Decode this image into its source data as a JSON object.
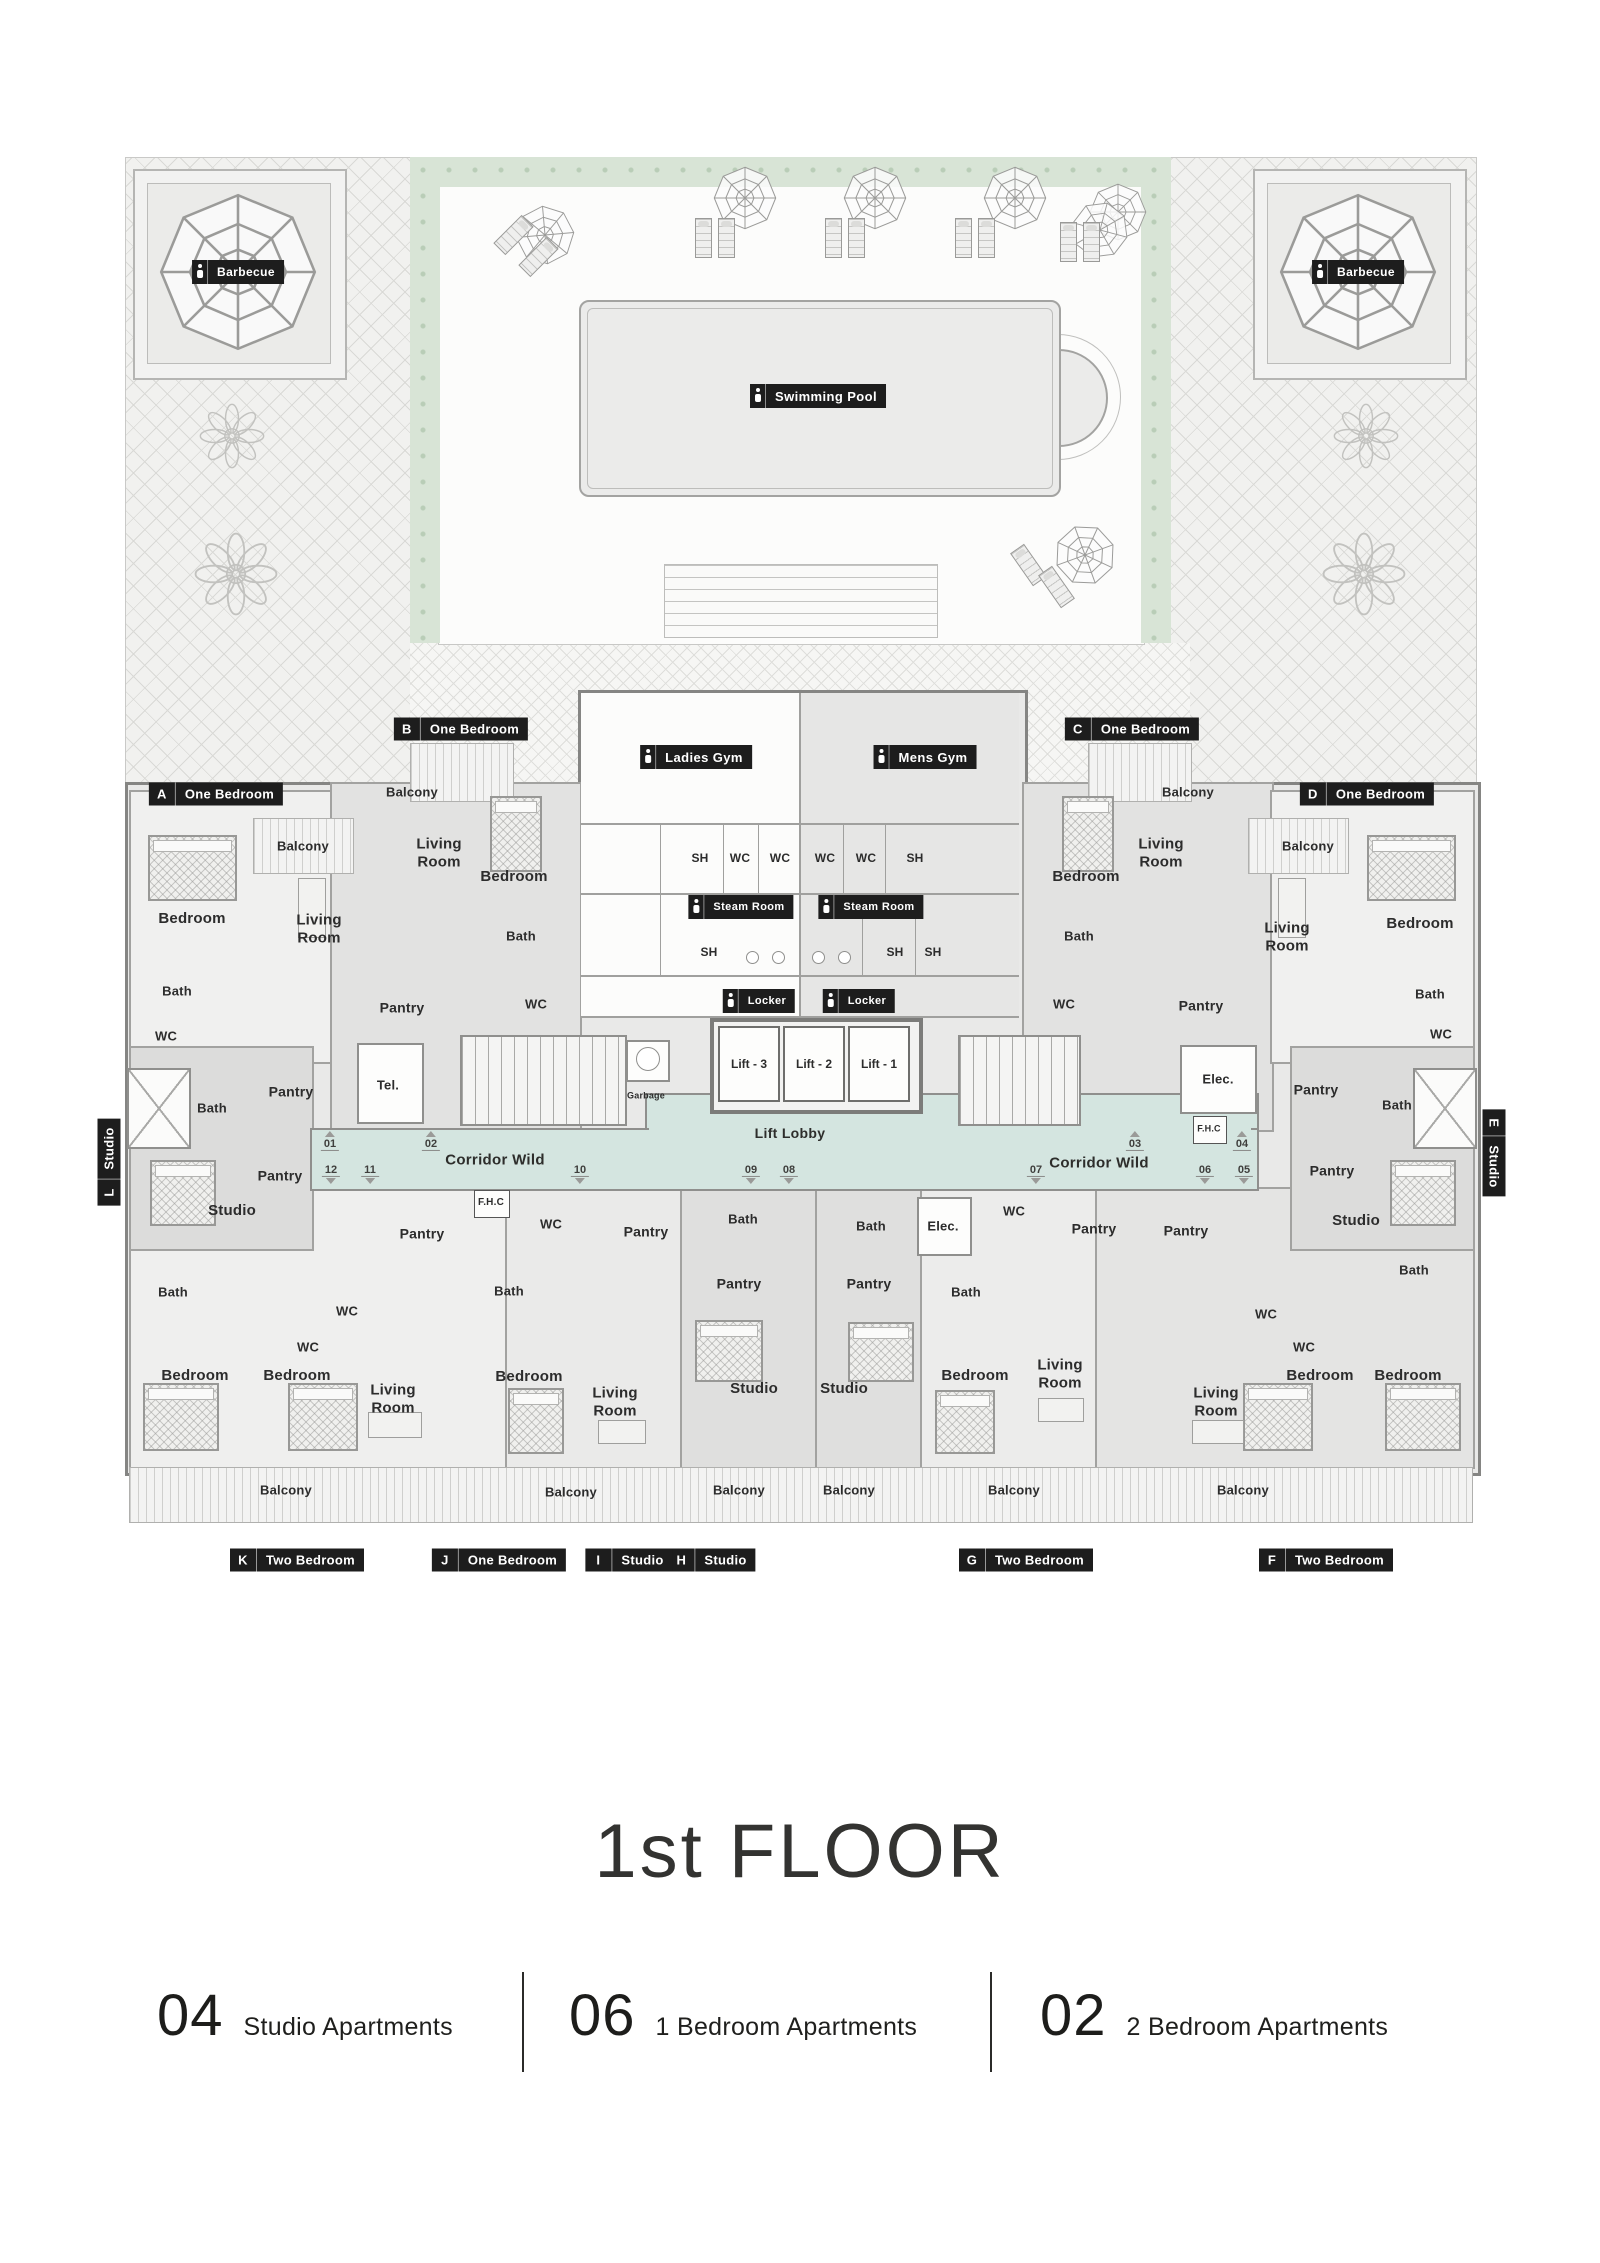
{
  "title": {
    "text": "1st FLOOR"
  },
  "legend": {
    "items": [
      {
        "count": "04",
        "label": "Studio Apartments"
      },
      {
        "count": "06",
        "label": "1 Bedroom Apartments"
      },
      {
        "count": "02",
        "label": "2 Bedroom Apartments"
      }
    ]
  },
  "colors": {
    "corridor": "#d4e5e0",
    "label_bg": "#1d1d1d",
    "hedge": "#d8e4d6"
  },
  "corridor": {
    "left": "Corridor Wild",
    "right": "Corridor Wild",
    "lobby": "Lift Lobby"
  },
  "lifts": [
    "Lift - 3",
    "Lift - 2",
    "Lift - 1"
  ],
  "amenity_labels": [
    {
      "id": "barbecue-left",
      "icon": "barbecue-icon",
      "text": "Barbecue",
      "x": 238,
      "y": 272,
      "fs": 12
    },
    {
      "id": "barbecue-right",
      "icon": "barbecue-icon",
      "text": "Barbecue",
      "x": 1358,
      "y": 272,
      "fs": 12
    },
    {
      "id": "swimming-pool",
      "icon": "swimmer-icon",
      "text": "Swimming Pool",
      "x": 818,
      "y": 396,
      "fs": 13
    },
    {
      "id": "ladies-gym",
      "icon": "person-icon",
      "text": "Ladies Gym",
      "x": 696,
      "y": 757,
      "fs": 13
    },
    {
      "id": "mens-gym",
      "icon": "person-icon",
      "text": "Mens Gym",
      "x": 925,
      "y": 757,
      "fs": 13
    },
    {
      "id": "steam-room-left",
      "icon": "person-icon",
      "text": "Steam Room",
      "x": 741,
      "y": 907,
      "fs": 11
    },
    {
      "id": "steam-room-right",
      "icon": "person-icon",
      "text": "Steam Room",
      "x": 871,
      "y": 907,
      "fs": 11
    },
    {
      "id": "locker-left",
      "icon": "person-icon",
      "text": "Locker",
      "x": 759,
      "y": 1001,
      "fs": 11
    },
    {
      "id": "locker-right",
      "icon": "person-icon",
      "text": "Locker",
      "x": 859,
      "y": 1001,
      "fs": 11
    }
  ],
  "units": [
    {
      "letter": "A",
      "type": "One Bedroom",
      "x": 216,
      "y": 794,
      "dir": "h"
    },
    {
      "letter": "B",
      "type": "One Bedroom",
      "x": 461,
      "y": 729,
      "dir": "h"
    },
    {
      "letter": "C",
      "type": "One Bedroom",
      "x": 1132,
      "y": 729,
      "dir": "h"
    },
    {
      "letter": "D",
      "type": "One Bedroom",
      "x": 1367,
      "y": 794,
      "dir": "h"
    },
    {
      "letter": "E",
      "type": "Studio",
      "x": 1494,
      "y": 1153,
      "dir": "vd"
    },
    {
      "letter": "F",
      "type": "Two Bedroom",
      "x": 1326,
      "y": 1560,
      "dir": "h"
    },
    {
      "letter": "G",
      "type": "Two Bedroom",
      "x": 1026,
      "y": 1560,
      "dir": "h"
    },
    {
      "letter": "H",
      "type": "Studio",
      "x": 712,
      "y": 1560,
      "dir": "h"
    },
    {
      "letter": "I",
      "type": "Studio",
      "x": 629,
      "y": 1560,
      "dir": "h"
    },
    {
      "letter": "J",
      "type": "One Bedroom",
      "x": 499,
      "y": 1560,
      "dir": "h"
    },
    {
      "letter": "K",
      "type": "Two Bedroom",
      "x": 297,
      "y": 1560,
      "dir": "h"
    },
    {
      "letter": "L",
      "type": "Studio",
      "x": 109,
      "y": 1162,
      "dir": "vu"
    }
  ],
  "doors": {
    "top": [
      {
        "n": "01",
        "x": 330
      },
      {
        "n": "02",
        "x": 431
      },
      {
        "n": "03",
        "x": 1135
      },
      {
        "n": "04",
        "x": 1242
      }
    ],
    "bottom": [
      {
        "n": "12",
        "x": 331
      },
      {
        "n": "11",
        "x": 370
      },
      {
        "n": "10",
        "x": 580
      },
      {
        "n": "09",
        "x": 751
      },
      {
        "n": "08",
        "x": 789
      },
      {
        "n": "07",
        "x": 1036
      },
      {
        "n": "06",
        "x": 1205
      },
      {
        "n": "05",
        "x": 1244
      }
    ]
  },
  "room_labels": [
    {
      "t": "Balcony",
      "x": 303,
      "y": 846,
      "fs": 13
    },
    {
      "t": "Bedroom",
      "x": 192,
      "y": 919
    },
    {
      "t": "Living Room",
      "x": 319,
      "y": 929,
      "w": 58
    },
    {
      "t": "Bath",
      "x": 177,
      "y": 991,
      "fs": 13
    },
    {
      "t": "WC",
      "x": 166,
      "y": 1036,
      "fs": 13
    },
    {
      "t": "Balcony",
      "x": 412,
      "y": 792,
      "fs": 13
    },
    {
      "t": "Living Room",
      "x": 439,
      "y": 853,
      "w": 58
    },
    {
      "t": "Bedroom",
      "x": 514,
      "y": 877
    },
    {
      "t": "Bath",
      "x": 521,
      "y": 936,
      "fs": 13
    },
    {
      "t": "WC",
      "x": 536,
      "y": 1004,
      "fs": 13
    },
    {
      "t": "Pantry",
      "x": 402,
      "y": 1008,
      "fs": 14
    },
    {
      "t": "Tel.",
      "x": 388,
      "y": 1085,
      "fs": 13
    },
    {
      "t": "Garbage",
      "x": 646,
      "y": 1096,
      "fs": 9
    },
    {
      "t": "Balcony",
      "x": 1188,
      "y": 792,
      "fs": 13
    },
    {
      "t": "Living Room",
      "x": 1161,
      "y": 853,
      "w": 58
    },
    {
      "t": "Bedroom",
      "x": 1086,
      "y": 877
    },
    {
      "t": "Bath",
      "x": 1079,
      "y": 936,
      "fs": 13
    },
    {
      "t": "WC",
      "x": 1064,
      "y": 1004,
      "fs": 13
    },
    {
      "t": "Pantry",
      "x": 1201,
      "y": 1006,
      "fs": 14
    },
    {
      "t": "Elec.",
      "x": 1218,
      "y": 1079,
      "fs": 13
    },
    {
      "t": "Balcony",
      "x": 1308,
      "y": 846,
      "fs": 13
    },
    {
      "t": "Living Room",
      "x": 1287,
      "y": 937,
      "w": 58
    },
    {
      "t": "Bedroom",
      "x": 1420,
      "y": 924
    },
    {
      "t": "Bath",
      "x": 1430,
      "y": 994,
      "fs": 13
    },
    {
      "t": "WC",
      "x": 1441,
      "y": 1034,
      "fs": 13
    },
    {
      "t": "Bath",
      "x": 212,
      "y": 1108,
      "fs": 13
    },
    {
      "t": "Pantry",
      "x": 291,
      "y": 1092,
      "fs": 14
    },
    {
      "t": "Pantry",
      "x": 280,
      "y": 1176,
      "fs": 14
    },
    {
      "t": "Studio",
      "x": 232,
      "y": 1211
    },
    {
      "t": "Bath",
      "x": 1397,
      "y": 1105,
      "fs": 13
    },
    {
      "t": "Pantry",
      "x": 1316,
      "y": 1090,
      "fs": 14
    },
    {
      "t": "Pantry",
      "x": 1332,
      "y": 1171,
      "fs": 14
    },
    {
      "t": "Studio",
      "x": 1356,
      "y": 1221
    },
    {
      "t": "Pantry",
      "x": 422,
      "y": 1234,
      "fs": 14
    },
    {
      "t": "Bath",
      "x": 173,
      "y": 1292,
      "fs": 13
    },
    {
      "t": "WC",
      "x": 347,
      "y": 1311,
      "fs": 13
    },
    {
      "t": "WC",
      "x": 308,
      "y": 1347,
      "fs": 13
    },
    {
      "t": "Bedroom",
      "x": 195,
      "y": 1376
    },
    {
      "t": "Bedroom",
      "x": 297,
      "y": 1376
    },
    {
      "t": "Living Room",
      "x": 393,
      "y": 1399,
      "w": 58
    },
    {
      "t": "F.H.C",
      "x": 491,
      "y": 1203,
      "fs": 10
    },
    {
      "t": "F.H.C",
      "x": 1209,
      "y": 1129,
      "fs": 9
    },
    {
      "t": "WC",
      "x": 551,
      "y": 1224,
      "fs": 13
    },
    {
      "t": "Pantry",
      "x": 646,
      "y": 1232,
      "fs": 14
    },
    {
      "t": "Bath",
      "x": 509,
      "y": 1291,
      "fs": 13
    },
    {
      "t": "Bedroom",
      "x": 529,
      "y": 1377
    },
    {
      "t": "Living Room",
      "x": 615,
      "y": 1402,
      "w": 58
    },
    {
      "t": "Bath",
      "x": 743,
      "y": 1219,
      "fs": 13
    },
    {
      "t": "Pantry",
      "x": 739,
      "y": 1284,
      "fs": 14
    },
    {
      "t": "Studio",
      "x": 754,
      "y": 1389
    },
    {
      "t": "Bath",
      "x": 871,
      "y": 1226,
      "fs": 13
    },
    {
      "t": "Pantry",
      "x": 869,
      "y": 1284,
      "fs": 14
    },
    {
      "t": "Studio",
      "x": 844,
      "y": 1389
    },
    {
      "t": "Elec.",
      "x": 943,
      "y": 1226,
      "fs": 13
    },
    {
      "t": "WC",
      "x": 1014,
      "y": 1211,
      "fs": 13
    },
    {
      "t": "Pantry",
      "x": 1094,
      "y": 1229,
      "fs": 14
    },
    {
      "t": "Bath",
      "x": 966,
      "y": 1292,
      "fs": 13
    },
    {
      "t": "Bedroom",
      "x": 975,
      "y": 1376
    },
    {
      "t": "Living Room",
      "x": 1060,
      "y": 1374,
      "w": 58
    },
    {
      "t": "Pantry",
      "x": 1186,
      "y": 1231,
      "fs": 14
    },
    {
      "t": "Living Room",
      "x": 1216,
      "y": 1402,
      "w": 58
    },
    {
      "t": "WC",
      "x": 1266,
      "y": 1314,
      "fs": 13
    },
    {
      "t": "WC",
      "x": 1304,
      "y": 1347,
      "fs": 13
    },
    {
      "t": "Bedroom",
      "x": 1320,
      "y": 1376
    },
    {
      "t": "Bedroom",
      "x": 1408,
      "y": 1376
    },
    {
      "t": "Bath",
      "x": 1414,
      "y": 1270,
      "fs": 13
    },
    {
      "t": "SH",
      "x": 700,
      "y": 858,
      "fs": 12
    },
    {
      "t": "WC",
      "x": 740,
      "y": 858,
      "fs": 12
    },
    {
      "t": "WC",
      "x": 780,
      "y": 858,
      "fs": 12
    },
    {
      "t": "WC",
      "x": 825,
      "y": 858,
      "fs": 12
    },
    {
      "t": "WC",
      "x": 866,
      "y": 858,
      "fs": 12
    },
    {
      "t": "SH",
      "x": 915,
      "y": 858,
      "fs": 12
    },
    {
      "t": "SH",
      "x": 709,
      "y": 952,
      "fs": 12
    },
    {
      "t": "SH",
      "x": 895,
      "y": 952,
      "fs": 12
    },
    {
      "t": "SH",
      "x": 933,
      "y": 952,
      "fs": 12
    },
    {
      "t": "Balcony",
      "x": 286,
      "y": 1490,
      "fs": 13
    },
    {
      "t": "Balcony",
      "x": 571,
      "y": 1492,
      "fs": 13
    },
    {
      "t": "Balcony",
      "x": 739,
      "y": 1490,
      "fs": 13
    },
    {
      "t": "Balcony",
      "x": 849,
      "y": 1490,
      "fs": 13
    },
    {
      "t": "Balcony",
      "x": 1014,
      "y": 1490,
      "fs": 13
    },
    {
      "t": "Balcony",
      "x": 1243,
      "y": 1490,
      "fs": 13
    }
  ]
}
